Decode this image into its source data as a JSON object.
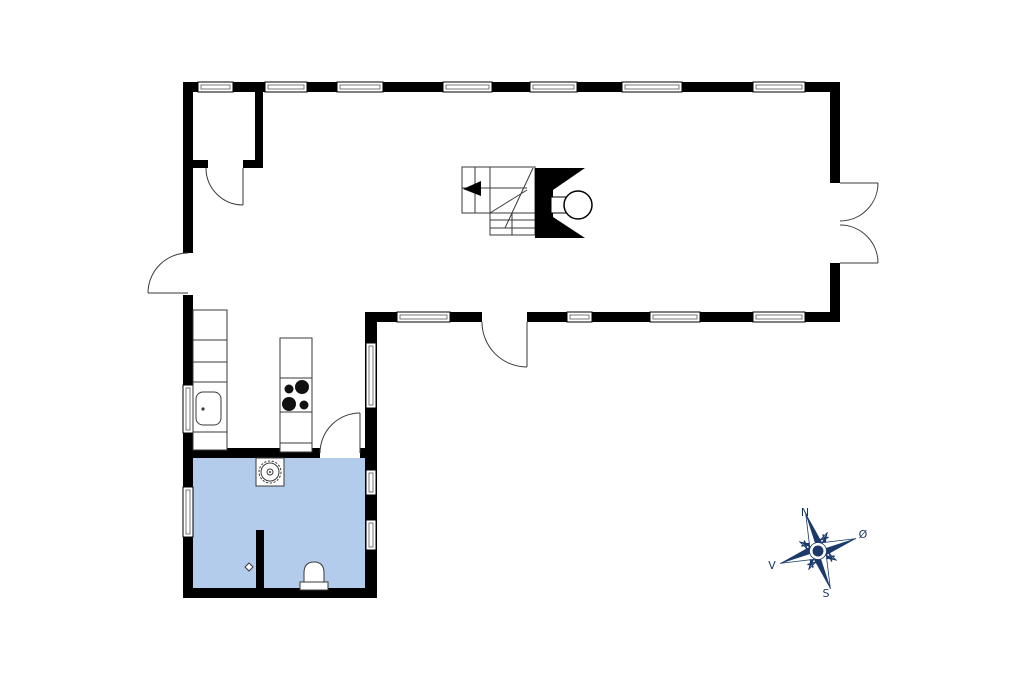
{
  "canvas": {
    "width": 1024,
    "height": 682,
    "background": "#ffffff"
  },
  "floorplan": {
    "wall_color": "#000000",
    "detail_line_color": "#3a3a3a",
    "bathroom_fill_color": "#b3cceb",
    "fixture_icons": [
      "staircase-icon",
      "fireplace-stove-icon",
      "kitchen-counter-icon",
      "kitchen-sink-icon",
      "cooktop-icon",
      "washing-machine-icon",
      "toilet-icon",
      "floor-drain-icon",
      "window-icon",
      "door-swing-icon",
      "double-door-icon",
      "compass-rose-icon"
    ]
  },
  "compass": {
    "color": "#1b3a6a",
    "label_color": "#16365f",
    "labels": {
      "north": "N",
      "east": "Ø",
      "south": "S",
      "west": "V"
    }
  }
}
